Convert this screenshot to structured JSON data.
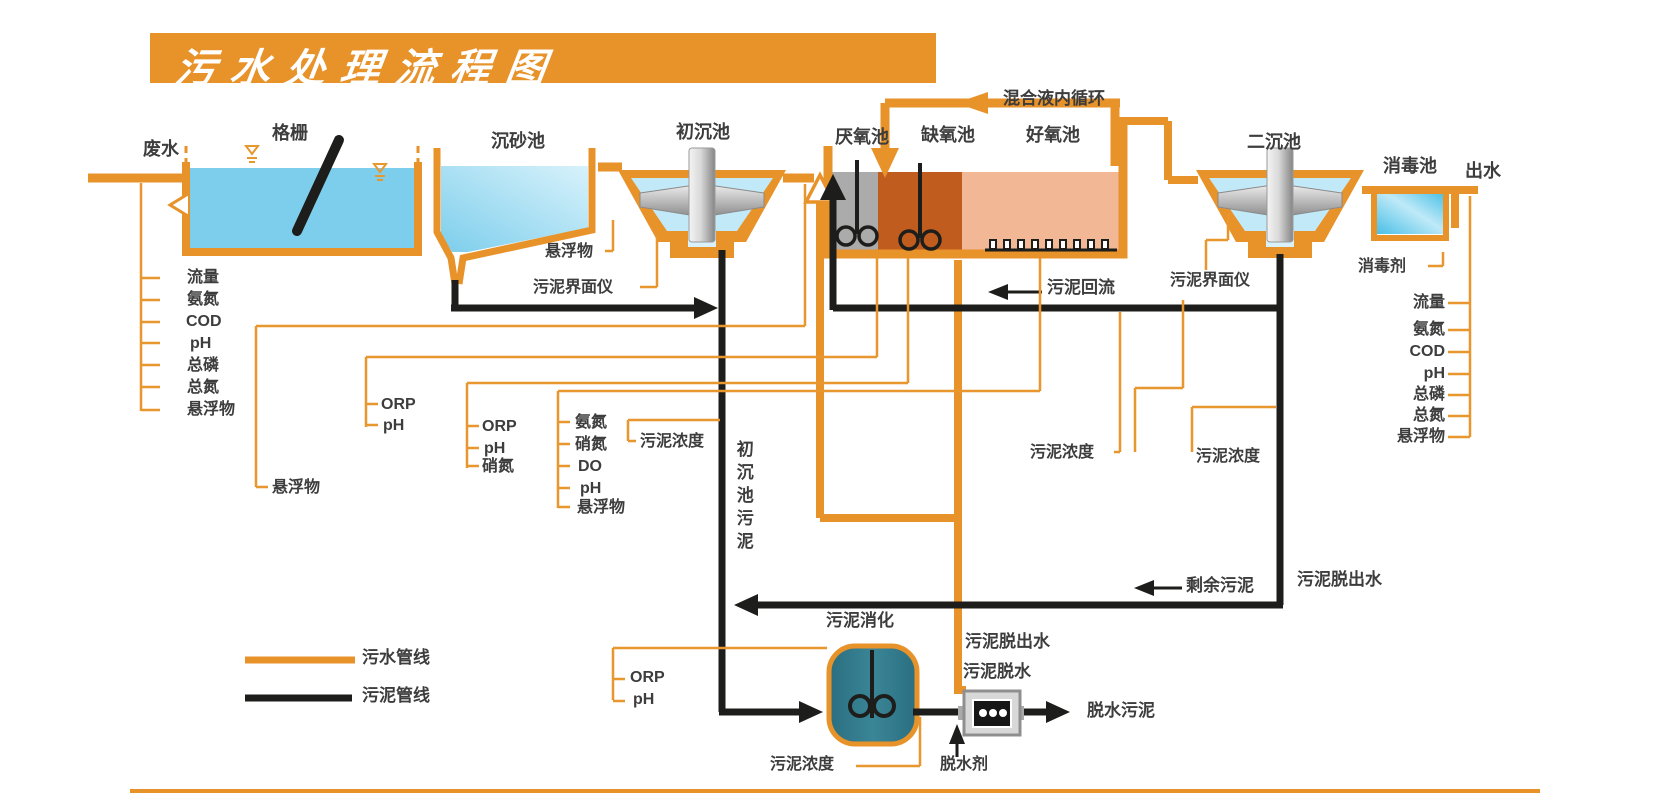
{
  "title": "污水处理流程图",
  "legend": {
    "water_line": "污水管线",
    "sludge_line": "污泥管线"
  },
  "stages": {
    "influent": "废水",
    "bar_screen": "格栅",
    "grit_chamber": "沉砂池",
    "primary_clarifier": "初沉池",
    "anaerobic_tank": "厌氧池",
    "anoxic_tank": "缺氧池",
    "aerobic_tank": "好氧池",
    "secondary_clarifier": "二沉池",
    "disinfection_tank": "消毒池",
    "effluent": "出水",
    "sludge_digester": "污泥消化",
    "sludge_dewatering": "污泥脱水",
    "dewatered_sludge": "脱水污泥"
  },
  "flows": {
    "internal_recycle": "混合液内循环",
    "sludge_return": "污泥回流",
    "excess_sludge": "剩余污泥",
    "primary_sludge": "初沉池污泥",
    "filtrate_right": "污泥脱出水",
    "filtrate_center": "污泥脱出水",
    "dewatering_agent": "脱水剂",
    "disinfectant": "消毒剂"
  },
  "sensors": {
    "influent_params": [
      "流量",
      "氨氮",
      "COD",
      "pH",
      "总磷",
      "总氮",
      "悬浮物"
    ],
    "effluent_params": [
      "流量",
      "氨氮",
      "COD",
      "pH",
      "总磷",
      "总氮",
      "悬浮物"
    ],
    "screen_ss": "悬浮物",
    "grit_ss": "悬浮物",
    "primary_interface_meter": "污泥界面仪",
    "secondary_interface_meter": "污泥界面仪",
    "primary_effluent_params": [
      "ORP",
      "pH"
    ],
    "anoxic_params": [
      "ORP",
      "pH",
      "硝氮"
    ],
    "aerobic_params": [
      "氨氮",
      "硝氮",
      "DO",
      "pH",
      "悬浮物"
    ],
    "primary_sludge_conc": "污泥浓度",
    "return_sludge_conc": "污泥浓度",
    "excess_sludge_conc": "污泥浓度",
    "digester_sludge_conc": "污泥浓度",
    "digester_params": [
      "ORP",
      "pH"
    ]
  },
  "colors": {
    "pipe_water": "#E8922A",
    "pipe_sludge": "#1D1D1B",
    "anaerobic_fill": "#ABABAB",
    "anoxic_fill": "#C05C1E",
    "aerobic_fill": "#F2B795",
    "digester_fill": "#337E90",
    "water_fill": "#7DCEEC"
  }
}
